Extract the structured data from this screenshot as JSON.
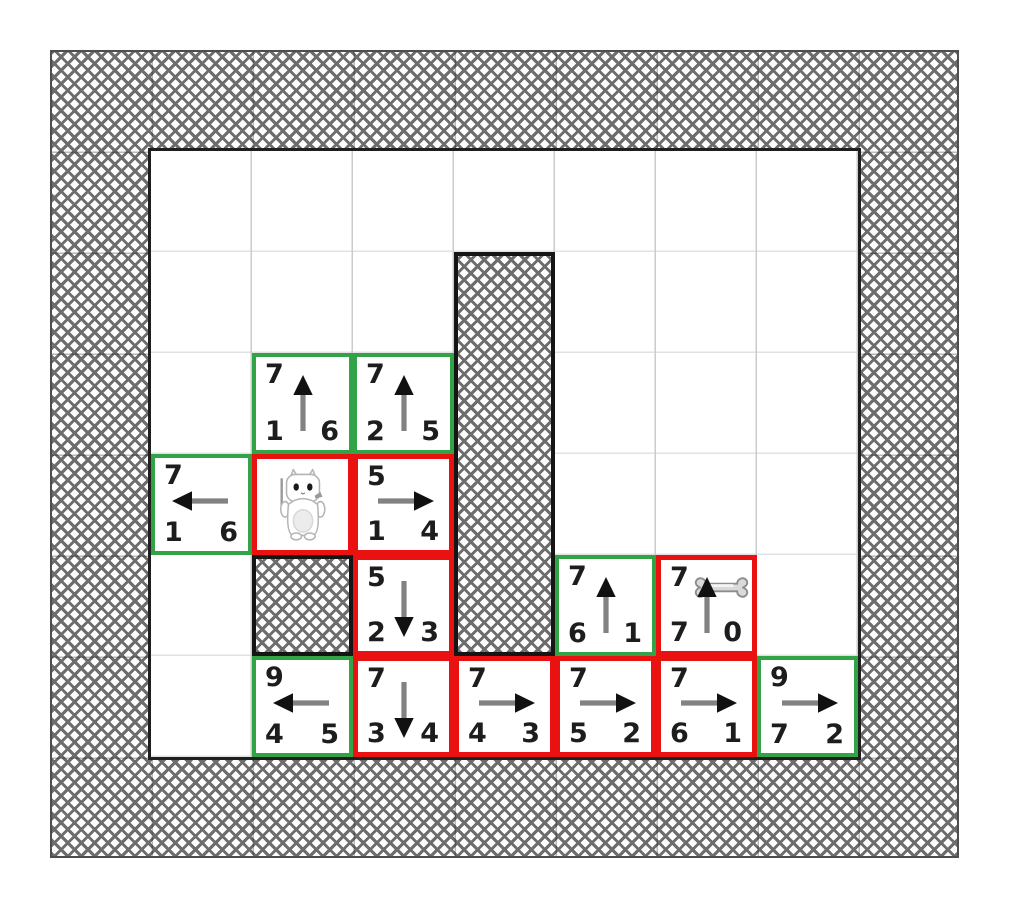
{
  "board": {
    "columns": 7,
    "rows": 6,
    "cell_px": 101,
    "wall_thickness_px": 101,
    "margin_px": {
      "left": 50,
      "top": 50
    }
  },
  "palette": {
    "background": "#ffffff",
    "frontier_border_green": "#33a347",
    "visited_border_red": "#ea1111",
    "wall_outline": "#1f1f1f",
    "hatch_gray": "#6d6d6d",
    "grid_line_vertical": "#cbcbcb",
    "grid_line_horizontal": "#e2e2e2",
    "number_color": "#1d1d1d",
    "arrow_shaft": "#828282",
    "arrow_head": "#111111"
  },
  "walls": {
    "outer_ring": true,
    "blocks": [
      {
        "col": 3,
        "row": 1,
        "span_cols": 1,
        "span_rows": 4
      },
      {
        "col": 1,
        "row": 4,
        "span_cols": 1,
        "span_rows": 1
      }
    ]
  },
  "entities": [
    {
      "type": "cat",
      "col": 1,
      "row": 3
    },
    {
      "type": "bone",
      "col": 5,
      "row": 4
    }
  ],
  "cells": [
    {
      "col": 1,
      "row": 2,
      "state": "frontier",
      "border": "green",
      "arrow": "up",
      "top": "7",
      "bottom_left": "1",
      "bottom_right": "6"
    },
    {
      "col": 2,
      "row": 2,
      "state": "frontier",
      "border": "green",
      "arrow": "up",
      "top": "7",
      "bottom_left": "2",
      "bottom_right": "5"
    },
    {
      "col": 0,
      "row": 3,
      "state": "frontier",
      "border": "green",
      "arrow": "left",
      "top": "7",
      "bottom_left": "1",
      "bottom_right": "6"
    },
    {
      "col": 1,
      "row": 3,
      "state": "visited",
      "border": "red",
      "entity": "cat"
    },
    {
      "col": 2,
      "row": 3,
      "state": "visited",
      "border": "red",
      "arrow": "right",
      "top": "5",
      "bottom_left": "1",
      "bottom_right": "4"
    },
    {
      "col": 2,
      "row": 4,
      "state": "visited",
      "border": "red",
      "arrow": "down",
      "top": "5",
      "bottom_left": "2",
      "bottom_right": "3"
    },
    {
      "col": 4,
      "row": 4,
      "state": "frontier",
      "border": "green",
      "arrow": "up",
      "top": "7",
      "bottom_left": "6",
      "bottom_right": "1"
    },
    {
      "col": 5,
      "row": 4,
      "state": "visited",
      "border": "red",
      "arrow": "up",
      "entity": "bone",
      "top": "7",
      "bottom_left": "7",
      "bottom_right": "0"
    },
    {
      "col": 1,
      "row": 5,
      "state": "frontier",
      "border": "green",
      "arrow": "left",
      "top": "9",
      "bottom_left": "4",
      "bottom_right": "5"
    },
    {
      "col": 2,
      "row": 5,
      "state": "visited",
      "border": "red",
      "arrow": "down",
      "top": "7",
      "bottom_left": "3",
      "bottom_right": "4"
    },
    {
      "col": 3,
      "row": 5,
      "state": "visited",
      "border": "red",
      "arrow": "right",
      "top": "7",
      "bottom_left": "4",
      "bottom_right": "3"
    },
    {
      "col": 4,
      "row": 5,
      "state": "visited",
      "border": "red",
      "arrow": "right",
      "top": "7",
      "bottom_left": "5",
      "bottom_right": "2"
    },
    {
      "col": 5,
      "row": 5,
      "state": "visited",
      "border": "red",
      "arrow": "right",
      "top": "7",
      "bottom_left": "6",
      "bottom_right": "1"
    },
    {
      "col": 6,
      "row": 5,
      "state": "frontier",
      "border": "green",
      "arrow": "right",
      "top": "9",
      "bottom_left": "7",
      "bottom_right": "2"
    }
  ]
}
